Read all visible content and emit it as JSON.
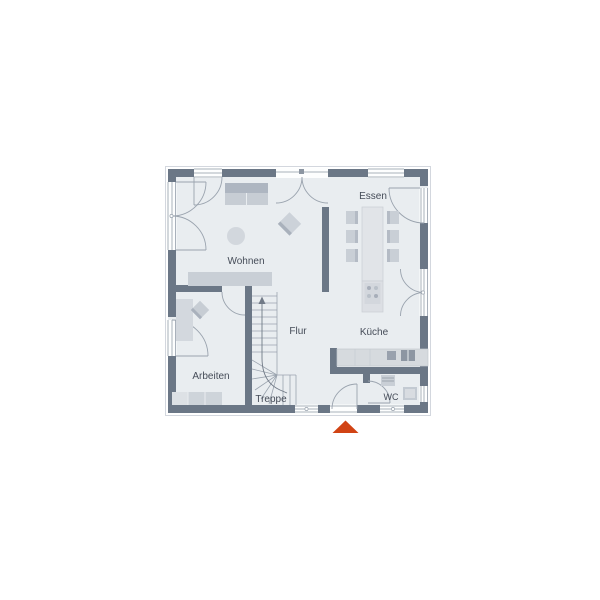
{
  "floorplan": {
    "title": "ground-floor-plan",
    "rooms": {
      "wohnen": {
        "label": "Wohnen"
      },
      "essen": {
        "label": "Essen"
      },
      "flur": {
        "label": "Flur"
      },
      "kueche": {
        "label": "Küche"
      },
      "arbeiten": {
        "label": "Arbeiten"
      },
      "treppe": {
        "label": "Treppe"
      },
      "wc": {
        "label": "WC"
      }
    },
    "colors": {
      "wall": "#6b7786",
      "floor": "#e9edf0",
      "furniture": "#d3d8de",
      "line": "#9aa3ae",
      "text": "#454c58",
      "entrance_marker": "#d14314"
    }
  }
}
